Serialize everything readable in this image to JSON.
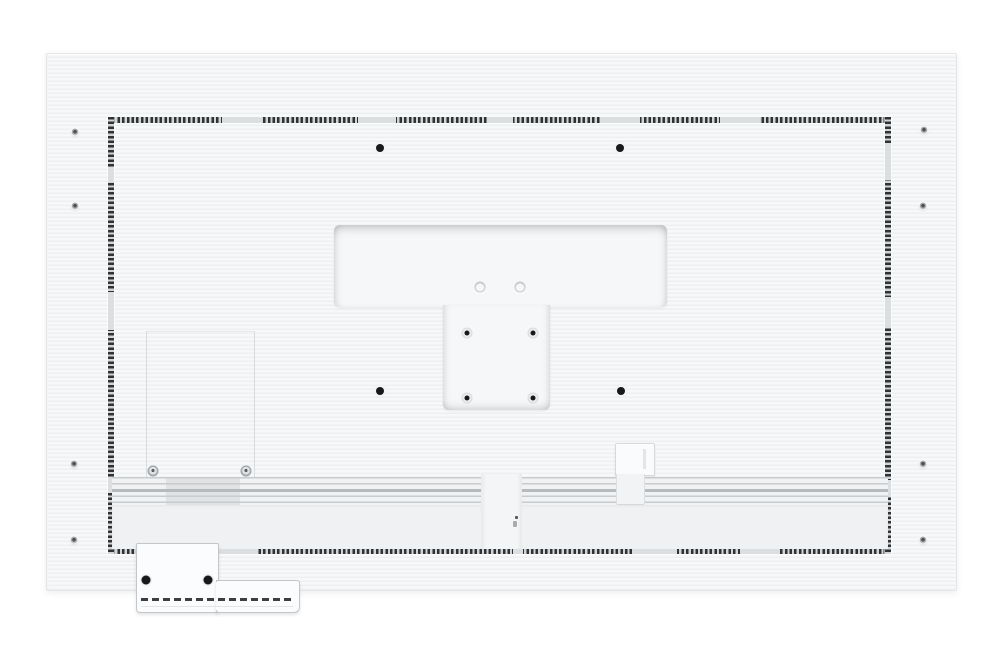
{
  "scene": {
    "description": "Rear view of a white flat-panel display back cover with perforated vent frame, recessed T-shaped wall-mount area, VESA holes, service panel, cable channel and detachable bottom-left tray",
    "visible_text": ""
  },
  "colors": {
    "background": "#ffffff",
    "panel_fill": "#f3f4f6",
    "vent_dash": "#303336",
    "recess_fill": "#f6f7f8",
    "hole_black": "#17191b",
    "band_line": "#c9cccf",
    "tray_fill": "#fbfcfd"
  },
  "features": {
    "outer_screws": [
      [
        75,
        132
      ],
      [
        75,
        206
      ],
      [
        74,
        464
      ],
      [
        74,
        540
      ],
      [
        924,
        130
      ],
      [
        923,
        206
      ],
      [
        923,
        464
      ],
      [
        923,
        540
      ]
    ],
    "mount_holes": [
      [
        380,
        148
      ],
      [
        620,
        148
      ],
      [
        380,
        391
      ],
      [
        621,
        391
      ]
    ],
    "vesa_holes": [
      [
        467,
        333
      ],
      [
        533,
        333
      ],
      [
        467,
        398
      ],
      [
        533,
        398
      ]
    ],
    "recess_rings": [
      [
        480,
        287
      ],
      [
        520,
        287
      ]
    ],
    "service_screws": [
      [
        153,
        471
      ],
      [
        246,
        471
      ]
    ],
    "tray_holes": [
      [
        146,
        580
      ],
      [
        208,
        580
      ]
    ],
    "vent_gaps": {
      "top": [
        [
          114,
          154
        ],
        [
          250,
          288
        ],
        [
          379,
          405
        ],
        [
          492,
          532
        ],
        [
          612,
          652
        ]
      ],
      "bottom": [
        [
          109,
          150
        ],
        [
          405,
          415
        ],
        [
          524,
          569
        ],
        [
          632,
          672
        ]
      ],
      "left": [
        [
          50,
          65
        ],
        [
          175,
          213
        ],
        [
          360,
          376
        ]
      ],
      "right": [
        [
          26,
          63
        ],
        [
          180,
          211
        ],
        [
          363,
          380
        ]
      ]
    }
  }
}
